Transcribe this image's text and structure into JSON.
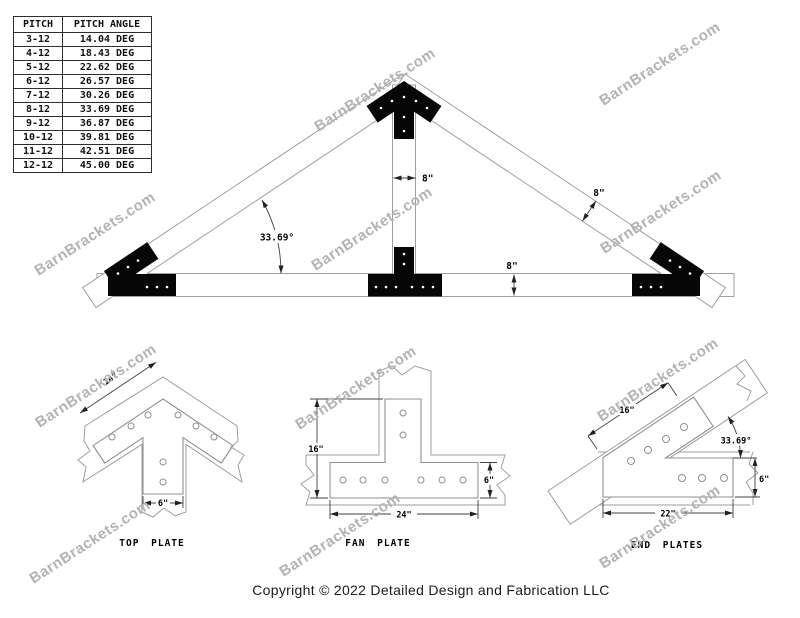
{
  "pitch_table": {
    "headers": [
      "PITCH",
      "PITCH ANGLE"
    ],
    "rows": [
      [
        "3-12",
        "14.04 DEG"
      ],
      [
        "4-12",
        "18.43 DEG"
      ],
      [
        "5-12",
        "22.62 DEG"
      ],
      [
        "6-12",
        "26.57 DEG"
      ],
      [
        "7-12",
        "30.26 DEG"
      ],
      [
        "8-12",
        "33.69 DEG"
      ],
      [
        "9-12",
        "36.87 DEG"
      ],
      [
        "10-12",
        "39.81 DEG"
      ],
      [
        "11-12",
        "42.51 DEG"
      ],
      [
        "12-12",
        "45.00 DEG"
      ]
    ]
  },
  "watermark": {
    "text": "BarnBrackets.com",
    "color": "#b3b3b3"
  },
  "truss": {
    "dim_king_post": "8\"",
    "dim_rafter": "8\"",
    "dim_chord": "8\"",
    "angle": "33.69°"
  },
  "details": {
    "top_plate": {
      "title": "TOP PLATE",
      "dim_arm": "14\"",
      "dim_leg": "6\""
    },
    "fan_plate": {
      "title": "FAN PLATE",
      "dim_height": "16\"",
      "dim_width": "24\"",
      "dim_side": "6\""
    },
    "end_plates": {
      "title": "END PLATES",
      "dim_arm": "16\"",
      "dim_length": "22\"",
      "dim_side": "6\"",
      "angle": "33.69°"
    }
  },
  "footer": {
    "copyright": "Copyright © 2022 Detailed Design and Fabrication LLC"
  },
  "plate_color": "#060606"
}
